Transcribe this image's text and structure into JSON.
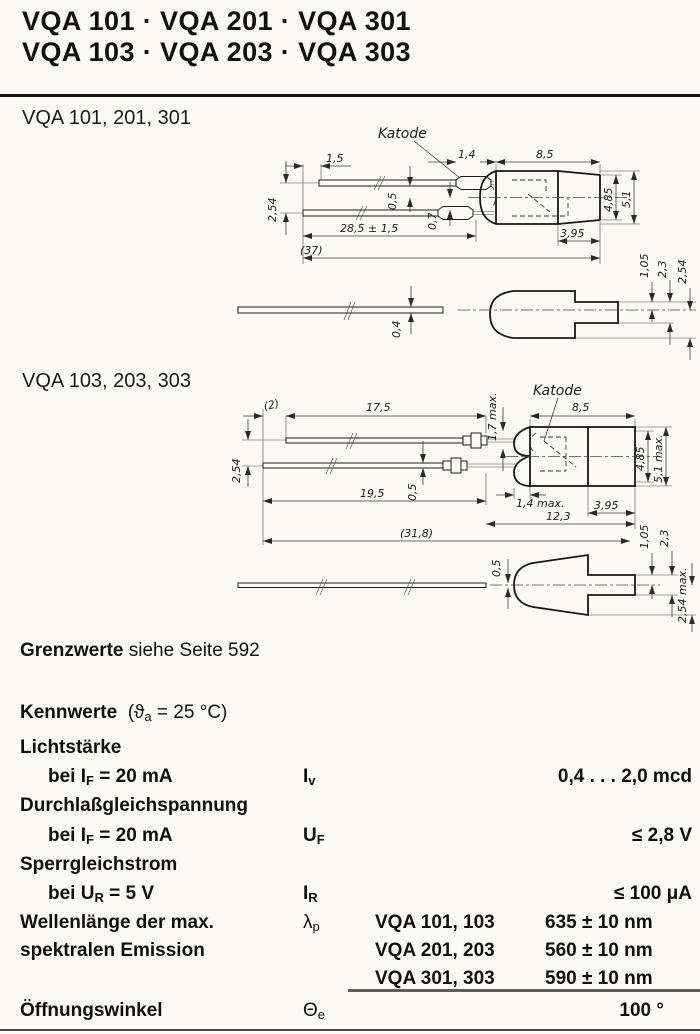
{
  "header": {
    "title_line1": "VQA 101 · VQA 201 · VQA 301",
    "title_line2": "VQA 103 · VQA 203 · VQA 303"
  },
  "sections": {
    "s1_label": "VQA 101, 201, 301",
    "s2_label": "VQA 103, 203, 303"
  },
  "drawing1": {
    "katode": "Katode",
    "dims": {
      "offset1_5": "1,5",
      "crimp1_4": "1,4",
      "body8_5": "8,5",
      "pitch2_54": "2,54",
      "off0_5": "0,5",
      "off0_7": "0,7",
      "lead28_5": "28,5 ± 1,5",
      "total37": "(37)",
      "cap3_95": "3,95",
      "h4_85": "4,85",
      "h5_1": "5,1",
      "s1_05": "1,05",
      "s2_3": "2,3",
      "s2_54": "2,54",
      "t0_4": "0,4"
    }
  },
  "drawing2": {
    "katode": "Katode",
    "dims": {
      "off2": "(2)",
      "lead17_5": "17,5",
      "crimp1_7": "1,7 max.",
      "body8_5": "8,5",
      "pitch2_54": "2,54",
      "t0_5": "0,5",
      "lead19_5": "19,5",
      "dome1_4": "1,4 max.",
      "body12_3": "12,3",
      "cap3_95": "3,95",
      "total31_8": "(31,8)",
      "h4_85": "4,85",
      "h5_1": "5,1 max.",
      "s0_5": "0,5",
      "s1_05": "1,05",
      "s2_3": "2,3",
      "s2_54": "2,54 max."
    }
  },
  "grenzwerte": {
    "bold": "Grenzwerte",
    "rest": " siehe Seite 592"
  },
  "kennwerte": {
    "heading": "Kennwerte",
    "cond_pre": "(ϑ",
    "cond_sub": "a",
    "cond_post": " = 25 °C)",
    "rows": [
      {
        "name": "Lichtstärke",
        "cond_pre": "bei I",
        "cond_sub": "F",
        "cond_post": " = 20 mA",
        "sym": "I",
        "sym_sub": "v",
        "value": "0,4 . . . 2,0 mcd"
      },
      {
        "name": "Durchlaßgleichspannung",
        "cond_pre": "bei I",
        "cond_sub": "F",
        "cond_post": " = 20 mA",
        "sym": "U",
        "sym_sub": "F",
        "value": "≤ 2,8 V"
      },
      {
        "name": "Sperrgleichstrom",
        "cond_pre": "bei U",
        "cond_sub": "R",
        "cond_post": " = 5 V",
        "sym": "I",
        "sym_sub": "R",
        "value": "≤ 100 μA"
      },
      {
        "name": "Wellenlänge der max.",
        "name2": "spektralen Emission",
        "sym": "λ",
        "sym_sub": "p",
        "variants": [
          {
            "types": "VQA 101, 103",
            "value": "635 ± 10 nm"
          },
          {
            "types": "VQA 201, 203",
            "value": "560 ± 10 nm"
          },
          {
            "types": "VQA 301, 303",
            "value": "590 ± 10 nm"
          }
        ]
      },
      {
        "name": "Öffnungswinkel",
        "sym": "Θ",
        "sym_sub": "e",
        "value": "100 °"
      }
    ]
  }
}
